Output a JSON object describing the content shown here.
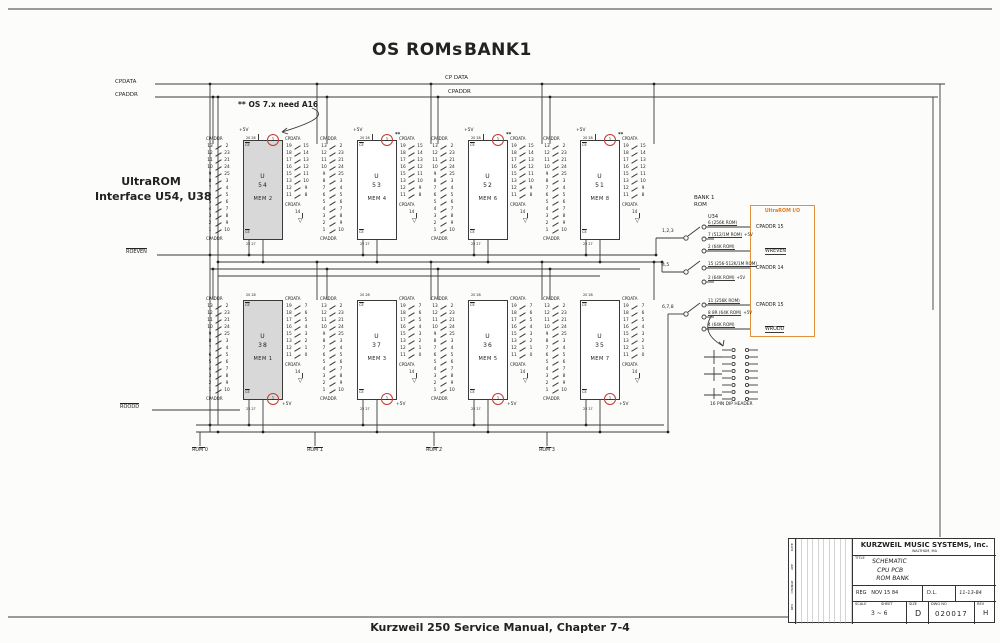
{
  "page": {
    "title_left": "OS ROMs",
    "title_right": "BANK1",
    "caption": "Kurzweil 250 Service Manual, Chapter 7-4"
  },
  "labels": {
    "cpdata_top": "CP DATA",
    "cpaddr_top": "CPADDR",
    "cpdata_left": "CPDATA",
    "cpaddr_left": "CPADDR",
    "roeven": "ROEVEN",
    "roodd": "ROODD",
    "a16_note": "** OS 7.x need A16",
    "ultrarom_line1": "UltraROM",
    "ultrarom_line2": "Interface U54, U38"
  },
  "chip_pins": {
    "addr_label": "CPADDR",
    "data_label": "CPDATA",
    "vcc": "+5V",
    "ce": "CE",
    "gnd_pin": "14",
    "gnd_symbol": "▽",
    "top_nums": "20  28",
    "bottom_nums": "22  27",
    "circle_pin": "1",
    "stars": "**",
    "addr_rows": [
      [
        "13",
        "2"
      ],
      [
        "12",
        "23"
      ],
      [
        "11",
        "21"
      ],
      [
        "10",
        "24"
      ],
      [
        "9",
        "25"
      ],
      [
        "8",
        "3"
      ],
      [
        "7",
        "4"
      ],
      [
        "6",
        "5"
      ],
      [
        "5",
        "6"
      ],
      [
        "4",
        "7"
      ],
      [
        "3",
        "8"
      ],
      [
        "2",
        "9"
      ],
      [
        "1",
        "10"
      ]
    ],
    "data_rows_high": [
      [
        "19",
        "15"
      ],
      [
        "18",
        "14"
      ],
      [
        "17",
        "13"
      ],
      [
        "16",
        "12"
      ],
      [
        "15",
        "11"
      ],
      [
        "13",
        "10"
      ],
      [
        "12",
        "9"
      ],
      [
        "11",
        "8"
      ]
    ],
    "data_rows_low": [
      [
        "19",
        "7"
      ],
      [
        "18",
        "6"
      ],
      [
        "17",
        "5"
      ],
      [
        "16",
        "4"
      ],
      [
        "15",
        "3"
      ],
      [
        "13",
        "2"
      ],
      [
        "12",
        "1"
      ],
      [
        "11",
        "0"
      ]
    ]
  },
  "chips": [
    {
      "ref": "U",
      "num": "54",
      "mem": "MEM 2",
      "grey": true,
      "row": "top",
      "stars": false,
      "data": "high"
    },
    {
      "ref": "U",
      "num": "53",
      "mem": "MEM 4",
      "grey": false,
      "row": "top",
      "stars": true,
      "data": "high"
    },
    {
      "ref": "U",
      "num": "52",
      "mem": "MEM 6",
      "grey": false,
      "row": "top",
      "stars": true,
      "data": "high"
    },
    {
      "ref": "U",
      "num": "51",
      "mem": "MEM 8",
      "grey": false,
      "row": "top",
      "stars": true,
      "data": "high"
    },
    {
      "ref": "U",
      "num": "38",
      "mem": "MEM 1",
      "grey": true,
      "row": "bottom",
      "stars": false,
      "data": "low"
    },
    {
      "ref": "U",
      "num": "37",
      "mem": "MEM 3",
      "grey": false,
      "row": "bottom",
      "stars": false,
      "data": "low"
    },
    {
      "ref": "U",
      "num": "36",
      "mem": "MEM 5",
      "grey": false,
      "row": "bottom",
      "stars": false,
      "data": "low"
    },
    {
      "ref": "U",
      "num": "35",
      "mem": "MEM 7",
      "grey": false,
      "row": "bottom",
      "stars": false,
      "data": "low"
    }
  ],
  "rom_labels": [
    "ROM 0",
    "ROM 1",
    "ROM 2",
    "ROM 3"
  ],
  "right_panel": {
    "bank_line1": "BANK 1",
    "bank_line2": "ROM",
    "u34": "U34",
    "header_label": "16 PIN DIP HEADER",
    "groups": [
      {
        "pins": "1,2,3",
        "options": [
          {
            "t": "6 (256K ROM)",
            "wire": true
          },
          {
            "t": "7 (512/1M ROM)",
            "v": "+5V"
          },
          {
            "t": "2 (64K ROM)",
            "wire": true
          }
        ]
      },
      {
        "pins": "4,5",
        "options": [
          {
            "t": "15 (256-512K/1M ROM)",
            "wire": true
          },
          {
            "t": "2 (64K ROM)",
            "v": "+5V"
          }
        ]
      },
      {
        "pins": "6,7,8",
        "options": [
          {
            "t": "11 (256K ROM)",
            "wire": true
          },
          {
            "t": "8 8R (64K ROM)",
            "v": "+5V"
          },
          {
            "t": "4 (64K ROM)",
            "wire": true
          }
        ]
      }
    ]
  },
  "ultrarom_io": {
    "title": "UltraROM I/O",
    "items": [
      {
        "t": "CPADDR 15"
      },
      {
        "t": "WREVEN",
        "ov": true
      },
      {
        "t": "CPADDR 14"
      },
      {
        "t": "CPADDR 15"
      },
      {
        "t": "WRODD",
        "ov": true
      }
    ]
  },
  "title_block": {
    "company": "KURZWEIL MUSIC SYSTEMS, Inc.",
    "location": "WALTHAM, MA",
    "title_label": "TITLE",
    "doc_line1": "SCHEMATIC",
    "doc_line2": "CPU PCB",
    "doc_line3": "ROM BANK",
    "eng": "REG",
    "eng_date": "NOV 15 84",
    "chk": "D.L.",
    "chk_date": "11-13-84",
    "sheet": "3 ~ 6",
    "size": "D",
    "number": "020017",
    "rev": "H",
    "labels": {
      "scale": "SCALE",
      "sheet": "SHEET",
      "size": "SIZE",
      "dwg": "DWG NO",
      "rev": "REV"
    },
    "side_labels": [
      "DATE",
      "APP",
      "CHANGE",
      "REV"
    ]
  },
  "colors": {
    "accent_orange": "#E2913D",
    "annotation_red": "#C23B33",
    "chip_grey": "#D8D8D8",
    "line": "#3A3A3A"
  }
}
